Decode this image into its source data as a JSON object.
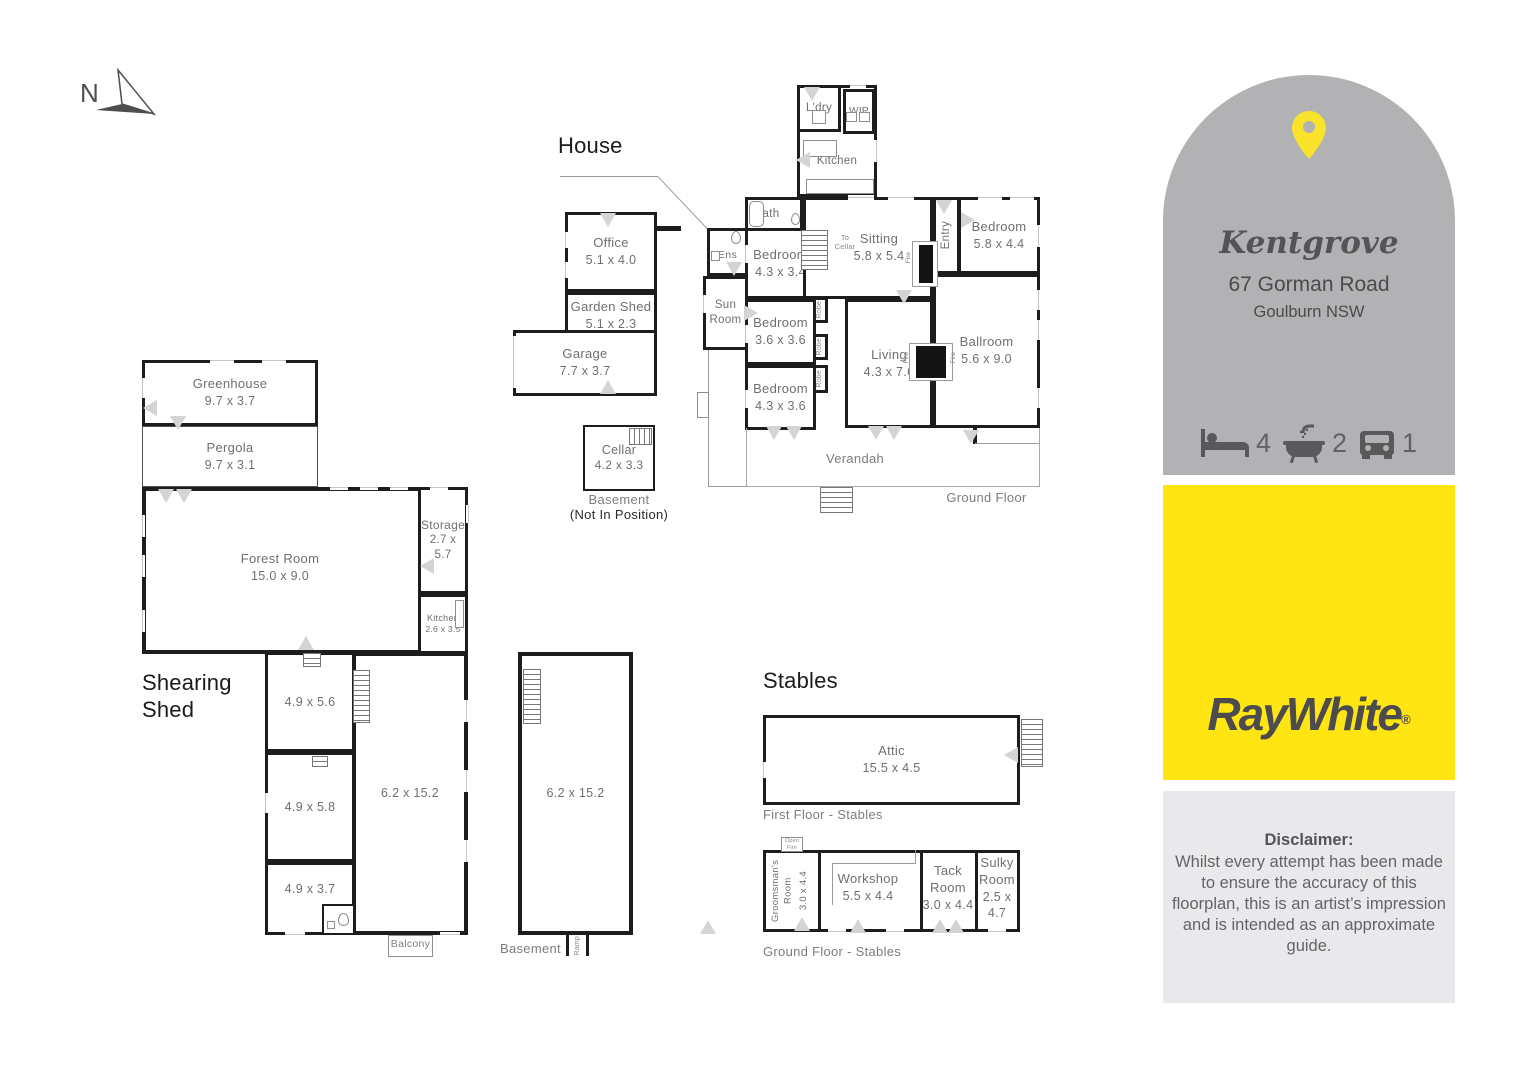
{
  "compass": {
    "north": "N"
  },
  "house": {
    "title": "House",
    "rooms": {
      "ldry": {
        "name": "L'dry"
      },
      "wip": {
        "name": "WIP"
      },
      "kitchen": {
        "name": "Kitchen"
      },
      "bath": {
        "name": "Bath"
      },
      "ens": {
        "name": "Ens"
      },
      "sun_room": {
        "name": "Sun Room"
      },
      "bedroom_a": {
        "name": "Bedroom",
        "dims": "4.3 x 3.4"
      },
      "bedroom_b": {
        "name": "Bedroom",
        "dims": "3.6 x 3.6"
      },
      "bedroom_c": {
        "name": "Bedroom",
        "dims": "4.3 x 3.6"
      },
      "sitting": {
        "name": "Sitting",
        "dims": "5.8 x 5.4"
      },
      "entry": {
        "name": "Entry"
      },
      "bedroom_d": {
        "name": "Bedroom",
        "dims": "5.8 x 4.4"
      },
      "ballroom": {
        "name": "Ballroom",
        "dims": "5.6 x 9.0"
      },
      "living": {
        "name": "Living",
        "dims": "4.3 x 7.6"
      },
      "office": {
        "name": "Office",
        "dims": "5.1 x 4.0"
      },
      "garden_shed": {
        "name": "Garden Shed",
        "dims": "5.1 x 2.3"
      },
      "garage": {
        "name": "Garage",
        "dims": "7.7 x 3.7"
      },
      "verandah": {
        "name": "Verandah"
      }
    },
    "labels": {
      "to_cellar_1": "To",
      "to_cellar_2": "Cellar",
      "robe": "Robe",
      "fire": "Fire",
      "ground_floor": "Ground Floor"
    },
    "cellar": {
      "name": "Cellar",
      "dims": "4.2 x 3.3",
      "caption1": "Basement",
      "caption2": "(Not In Position)"
    }
  },
  "shearing_shed": {
    "title_line1": "Shearing",
    "title_line2": "Shed",
    "rooms": {
      "greenhouse": {
        "name": "Greenhouse",
        "dims": "9.7 x 3.7"
      },
      "pergola": {
        "name": "Pergola",
        "dims": "9.7 x 3.1"
      },
      "forest_room": {
        "name": "Forest Room",
        "dims": "15.0 x 9.0"
      },
      "storage": {
        "name": "Storage",
        "dims": "2.7 x 5.7"
      },
      "kitchen": {
        "name": "Kitchen",
        "dims": "2.6 x 3.5"
      },
      "room_a": {
        "dims": "4.9 x 5.6"
      },
      "room_b": {
        "dims": "4.9 x 5.8"
      },
      "room_c": {
        "dims": "4.9 x 3.7"
      },
      "main": {
        "dims": "6.2 x 15.2"
      },
      "balcony": {
        "name": "Balcony"
      }
    }
  },
  "basement": {
    "dims": "6.2 x 15.2",
    "caption": "Basement",
    "ramp": "Ramp"
  },
  "stables": {
    "title": "Stables",
    "attic": {
      "name": "Attic",
      "dims": "15.5 x 4.5"
    },
    "first_floor_caption": "First Floor - Stables",
    "ground_floor_caption": "Ground Floor - Stables",
    "open_fire": "Open Fire",
    "rooms": {
      "groomsman": {
        "name": "Groomsman's Room",
        "dims": "3.0 x 4.4"
      },
      "workshop": {
        "name": "Workshop",
        "dims": "5.5 x 4.4"
      },
      "tack": {
        "name": "Tack Room",
        "dims": "3.0 x 4.4"
      },
      "sulky": {
        "name": "Sulky Room",
        "dims": "2.5 x 4.7"
      }
    }
  },
  "info_panel": {
    "property_name": "Kentgrove",
    "address_line1": "67 Gorman Road",
    "address_line2": "Goulburn NSW",
    "features": {
      "beds": "4",
      "baths": "2",
      "cars": "1"
    },
    "brand": {
      "logo_text": "RayWhite",
      "registered_mark": "®"
    },
    "disclaimer_title": "Disclaimer:",
    "disclaimer_body": "Whilst every attempt has been made to ensure the accuracy of this floorplan, this is an artist’s impression and is intended as an approximate guide.",
    "colors": {
      "arch_gray": "#b2b1b3",
      "brand_yellow": "#ffe512",
      "disclaimer_bg": "#e9e8ea",
      "pin_yellow": "#f9e32b",
      "icon_gray": "#59595c",
      "wall_black": "#1d1d1d"
    }
  }
}
